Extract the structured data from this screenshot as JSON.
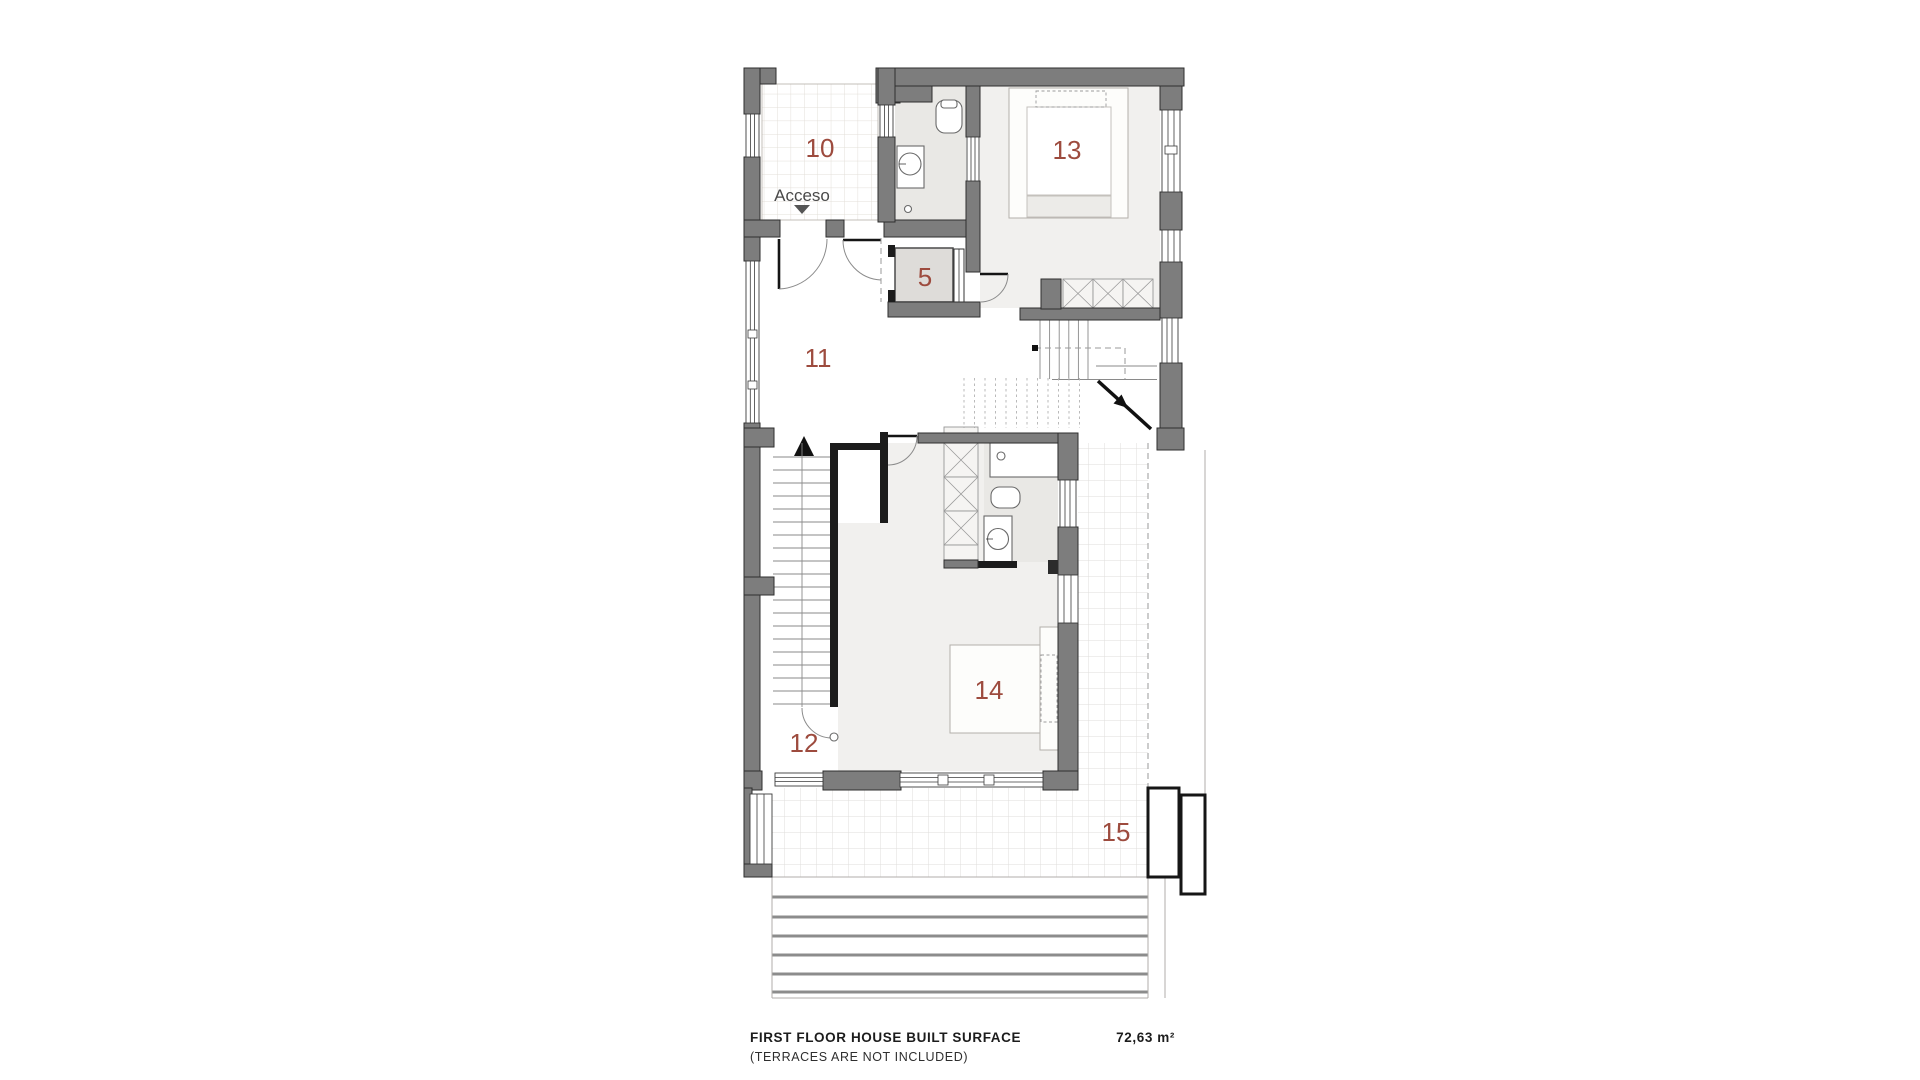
{
  "plan": {
    "access_label": "Acceso",
    "room_labels": {
      "r10": "10",
      "r13": "13",
      "r5": "5",
      "r11": "11",
      "r12": "12",
      "r14": "14",
      "r15": "15"
    }
  },
  "footer": {
    "title": "FIRST FLOOR HOUSE BUILT SURFACE",
    "subtitle": "(TERRACES ARE NOT INCLUDED)",
    "area": "72,63 m²"
  },
  "colors": {
    "wall": "#7d7d7d",
    "wall_dark": "#1c1c1c",
    "room_number": "#9d4b3e",
    "floor_light": "#f1f0ee",
    "floor_bath": "#e9e8e5",
    "footer_text": "#1c1c1c"
  }
}
